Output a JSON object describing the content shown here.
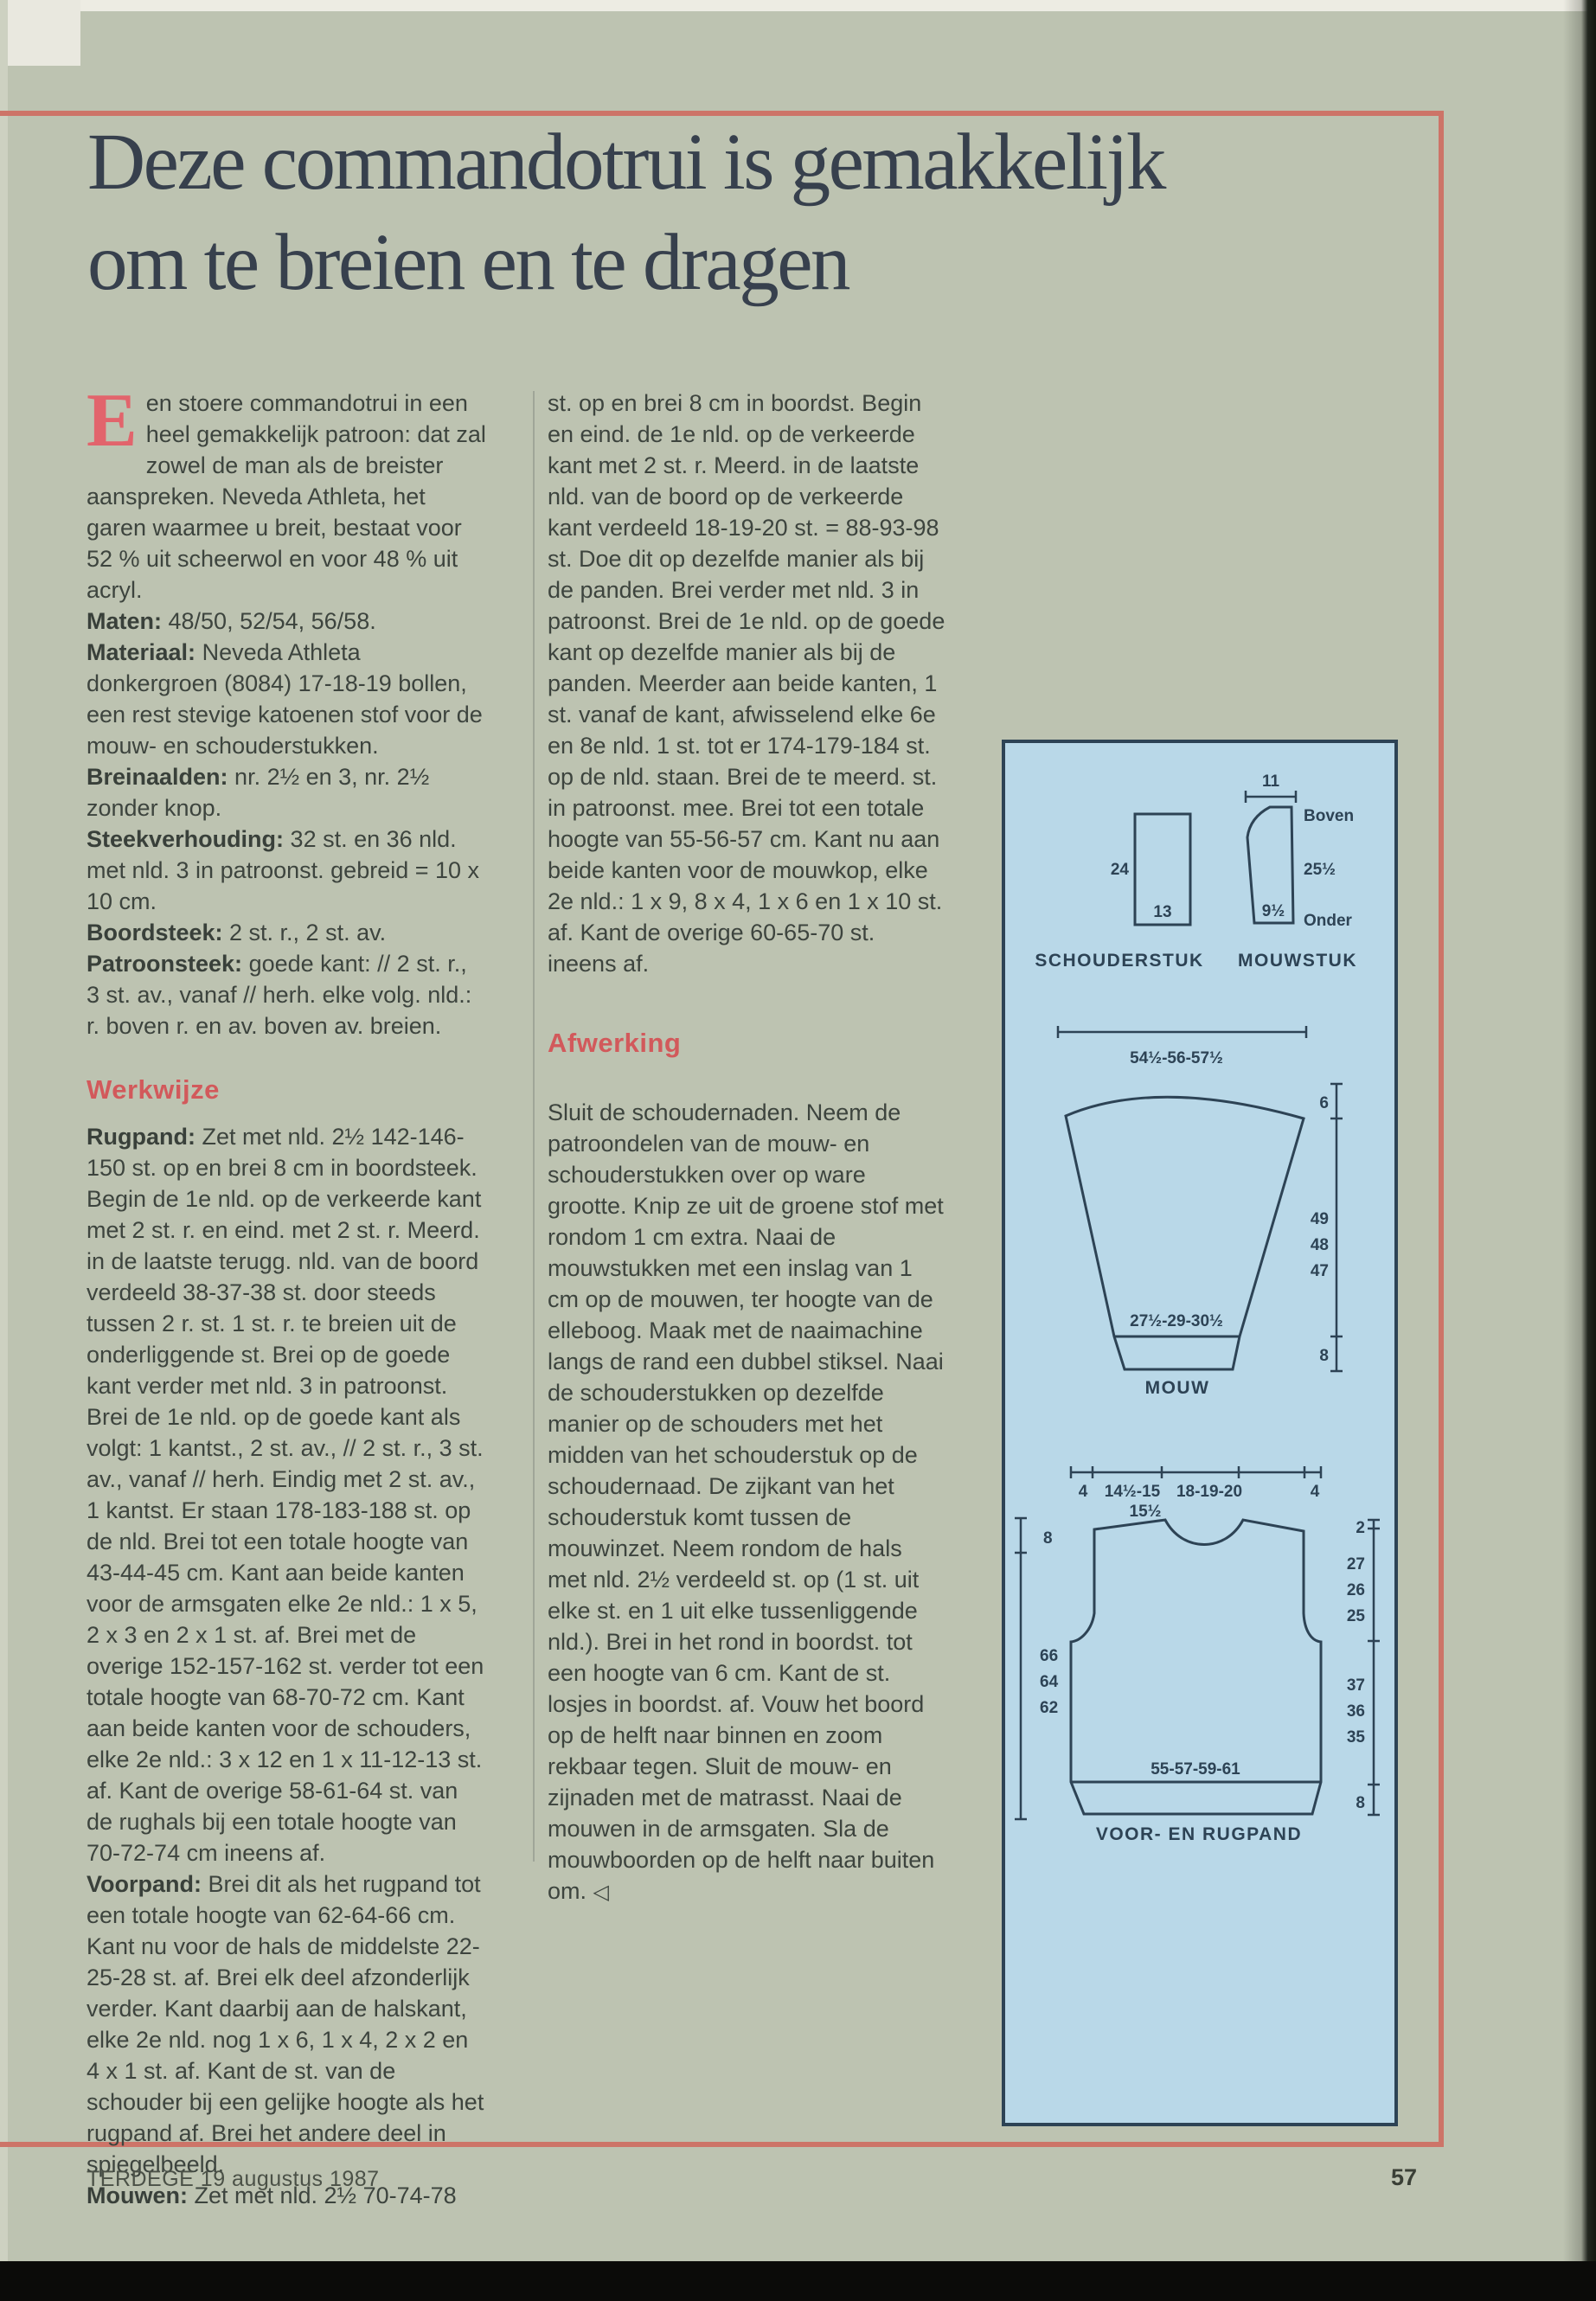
{
  "page": {
    "title_line1": "Deze commandotrui is gemakkelijk",
    "title_line2": "om te breien en te dragen",
    "footer_left": "TERDEGE 19 augustus 1987",
    "page_number": "57"
  },
  "colors": {
    "page_bg": "#bdc3b1",
    "accent_red": "#d2595b",
    "frame_red": "#cd7468",
    "dropcap_red": "#e2646c",
    "title_ink": "#37404d",
    "body_ink": "#3d443e",
    "panel_bg": "#b9d8e8",
    "panel_ink": "#2d4355"
  },
  "article": {
    "dropcap": "E",
    "intro": "en stoere commandotrui in een heel gemakkelijk patroon: dat zal zowel de man als de breister aanspreken. Neveda Athleta, het garen waarmee u breit, bestaat voor 52 % uit scheerwol en voor 48 % uit acryl.",
    "specs": [
      {
        "label": "Maten:",
        "text": " 48/50, 52/54, 56/58."
      },
      {
        "label": "Materiaal:",
        "text": " Neveda Athleta donkergroen (8084) 17-18-19 bollen, een rest stevige katoenen stof voor de mouw- en schouderstukken."
      },
      {
        "label": "Breinaalden:",
        "text": " nr. 2½ en 3, nr. 2½ zonder knop."
      },
      {
        "label": "Steekverhouding:",
        "text": " 32 st. en 36 nld. met nld. 3 in patroonst. gebreid = 10 x 10 cm."
      },
      {
        "label": "Boordsteek:",
        "text": " 2 st. r., 2 st. av."
      },
      {
        "label": "Patroonsteek:",
        "text": " goede kant: // 2 st. r., 3 st. av., vanaf // herh. elke volg. nld.: r. boven r. en av. boven av. breien."
      }
    ],
    "werkwijze_heading": "Werkwijze",
    "werkwijze": [
      {
        "label": "Rugpand:",
        "text": " Zet met nld. 2½ 142-146-150 st. op en brei 8 cm in boordsteek. Begin de 1e nld. op de verkeerde kant met 2 st. r. en eind. met 2 st. r. Meerd. in de laatste terugg. nld. van de boord verdeeld 38-37-38 st. door steeds tussen 2 r. st. 1 st. r. te breien uit de onderliggende st. Brei op de goede kant verder met nld. 3 in patroonst. Brei de 1e nld. op de goede kant als volgt: 1 kantst., 2 st. av., // 2 st. r., 3 st. av., vanaf // herh. Eindig met 2 st. av., 1 kantst. Er staan 178-183-188 st. op de nld. Brei tot een totale hoogte van 43-44-45 cm. Kant aan beide kanten voor de armsgaten elke 2e nld.: 1 x 5, 2 x 3 en 2 x 1 st. af. Brei met de overige 152-157-162 st. verder tot een totale hoogte van 68-70-72 cm. Kant aan beide kanten voor de schouders, elke 2e nld.: 3 x 12 en 1 x 11-12-13 st. af. Kant de overige 58-61-64 st. van de rughals bij een totale hoogte van 70-72-74 cm ineens af."
      },
      {
        "label": "Voorpand:",
        "text": " Brei dit als het rugpand tot een totale hoogte van 62-64-66 cm. Kant nu voor de hals de middelste 22-25-28 st. af. Brei elk deel afzonderlijk verder. Kant daarbij aan de halskant, elke 2e nld. nog 1 x 6, 1 x 4, 2 x 2 en 4 x 1 st. af. Kant de st. van de schouder bij een gelijke hoogte als het rugpand af. Brei het andere deel in spiegelbeeld."
      },
      {
        "label": "Mouwen:",
        "text": " Zet met nld. 2½ 70-74-78"
      }
    ],
    "sleeves_continued": "st. op en brei 8 cm in boordst. Begin en eind. de 1e nld. op de verkeerde kant met 2 st. r. Meerd. in de laatste nld. van de boord op de verkeerde kant verdeeld 18-19-20 st. = 88-93-98 st. Doe dit op dezelfde manier als bij de panden. Brei verder met nld. 3 in patroonst. Brei de 1e nld. op de goede kant op dezelfde manier als bij de panden. Meerder aan beide kanten, 1 st. vanaf de kant, afwisselend elke 6e en 8e nld. 1 st. tot er 174-179-184 st. op de nld. staan. Brei de te meerd. st. in patroonst. mee. Brei tot een totale hoogte van 55-56-57 cm. Kant nu aan beide kanten voor de mouwkop, elke 2e nld.: 1 x 9, 8 x 4, 1 x 6 en 1 x 10 st. af. Kant de overige 60-65-70 st. ineens af.",
    "afwerking_heading": "Afwerking",
    "afwerking": "Sluit de schoudernaden. Neem de patroondelen van de mouw- en schouderstukken over op ware grootte. Knip ze uit de groene stof met rondom 1 cm extra. Naai de mouwstukken met een inslag van 1 cm op de mouwen, ter hoogte van de elleboog. Maak met de naaimachine langs de rand een dubbel stiksel. Naai de schouderstukken op dezelfde manier op de schouders met het midden van het schouderstuk op de schoudernaad. De zijkant van het schouderstuk komt tussen de mouwinzet. Neem rondom de hals met nld. 2½ verdeeld st. op (1 st. uit elke st. en 1 uit elke tussenliggende nld.). Brei in het rond in boordst. tot een hoogte van 6 cm. Kant de st. losjes in boordst. af. Vouw het boord op de helft naar binnen en zoom rekbaar tegen. Sluit de mouw- en zijnaden met de matrasst. Naai de mouwen in de armsgaten. Sla de mouwboorden op de helft naar buiten om.",
    "end_marker": "◁"
  },
  "diagrams": {
    "schouderstuk": {
      "label": "SCHOUDERSTUK",
      "side": "24",
      "bottom": "13"
    },
    "mouwstuk": {
      "label": "MOUWSTUK",
      "top": "11",
      "boven": "Boven",
      "side": "25½",
      "bottom": "9½",
      "onder": "Onder"
    },
    "mouw": {
      "label": "MOUW",
      "top_width": "54½-56-57½",
      "cuff_width": "27½-29-30½",
      "cap_height": "6",
      "lengths": [
        "49",
        "48",
        "47"
      ],
      "cuff_height": "8"
    },
    "pand": {
      "label": "VOOR- EN RUGPAND",
      "edge_left": "4",
      "shoulder": "14½-15",
      "neck": "18-19-20",
      "edge_right": "4",
      "shoulder_row2": "15½",
      "armhole_height": "8",
      "body_heights": [
        "66",
        "64",
        "62"
      ],
      "neck_depth": "2",
      "yoke_heights": [
        "27",
        "26",
        "25"
      ],
      "lower_heights": [
        "37",
        "36",
        "35"
      ],
      "rib_height": "8",
      "bottom_width": "55-57-59-61"
    }
  }
}
